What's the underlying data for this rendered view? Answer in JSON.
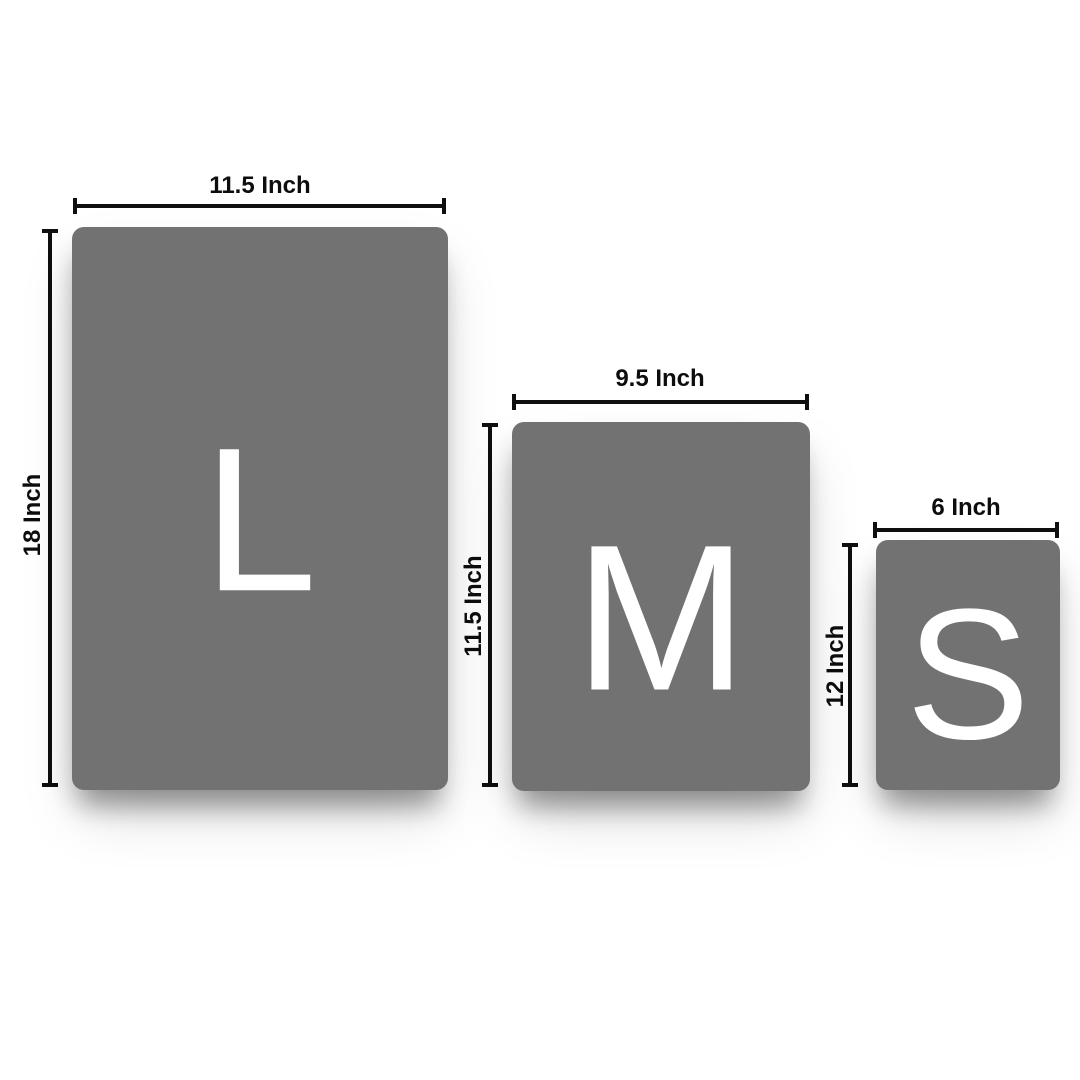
{
  "diagram": {
    "background_color": "#ffffff",
    "board_color": "#727272",
    "letter_color": "#ffffff",
    "dimension_color": "#0f0f0f"
  },
  "sizes": [
    {
      "code": "L",
      "width_label": "11.5 Inch",
      "height_label": "18 Inch"
    },
    {
      "code": "M",
      "width_label": "9.5 Inch",
      "height_label": "11.5 Inch"
    },
    {
      "code": "S",
      "width_label": "6 Inch",
      "height_label": "12 Inch"
    }
  ]
}
